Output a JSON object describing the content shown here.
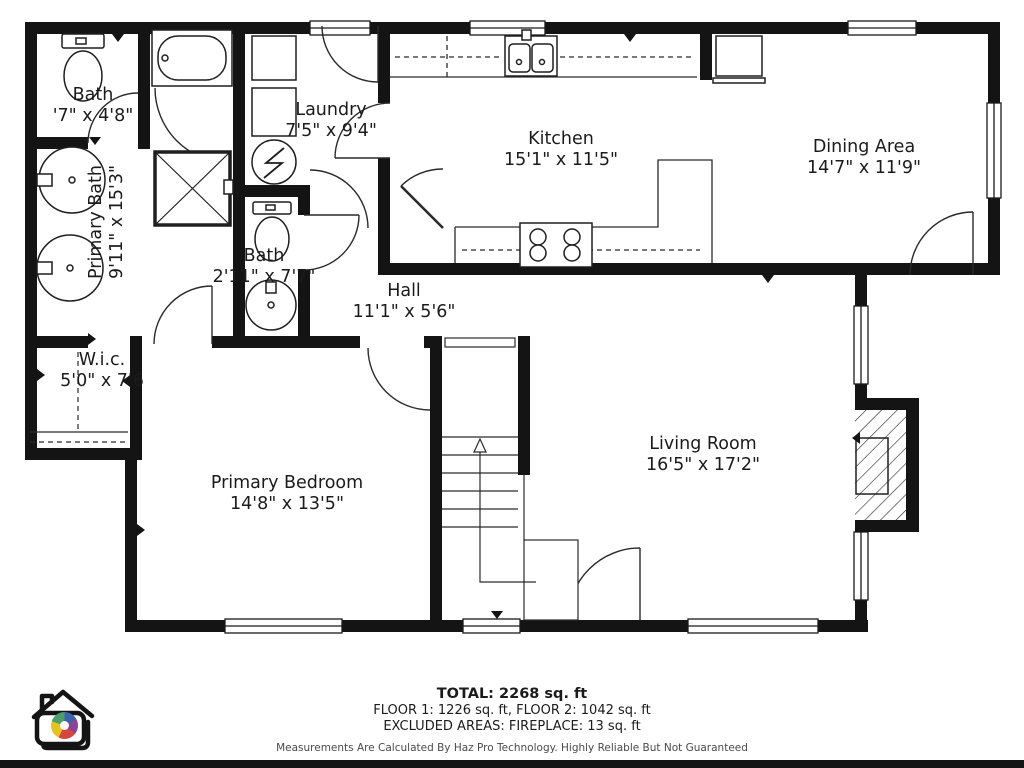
{
  "rooms": {
    "bath_upper": {
      "name": "Bath",
      "dims": "'7\" x 4'8\""
    },
    "primary_bath": {
      "name": "Primary Bath",
      "dims": "9'11\" x 15'3\""
    },
    "laundry": {
      "name": "Laundry",
      "dims": "7'5\" x 9'4\""
    },
    "kitchen": {
      "name": "Kitchen",
      "dims": "15'1\" x 11'5\""
    },
    "dining": {
      "name": "Dining Area",
      "dims": "14'7\" x 11'9\""
    },
    "bath_hall": {
      "name": "Bath",
      "dims": "2'11\" x 7'7\""
    },
    "hall": {
      "name": "Hall",
      "dims": "11'1\" x 5'6\""
    },
    "wic": {
      "name": "W.i.c.",
      "dims": "5'0\" x 7'6"
    },
    "primary_bedroom": {
      "name": "Primary Bedroom",
      "dims": "14'8\" x 13'5\""
    },
    "living": {
      "name": "Living Room",
      "dims": "16'5\" x 17'2\""
    }
  },
  "summary": {
    "total": "TOTAL: 2268 sq. ft",
    "floors": "FLOOR 1: 1226 sq. ft, FLOOR 2: 1042 sq. ft",
    "excluded": "EXCLUDED AREAS: FIREPLACE: 13 sq. ft",
    "disclaimer": "Measurements Are Calculated By Haz Pro Technology. Highly Reliable But Not Guaranteed"
  },
  "colors": {
    "wall": "#141414",
    "line": "#2a2a2a",
    "logo_segments": [
      "#3f62ae",
      "#8b4397",
      "#d64541",
      "#e7c11d",
      "#4aa06b"
    ]
  }
}
